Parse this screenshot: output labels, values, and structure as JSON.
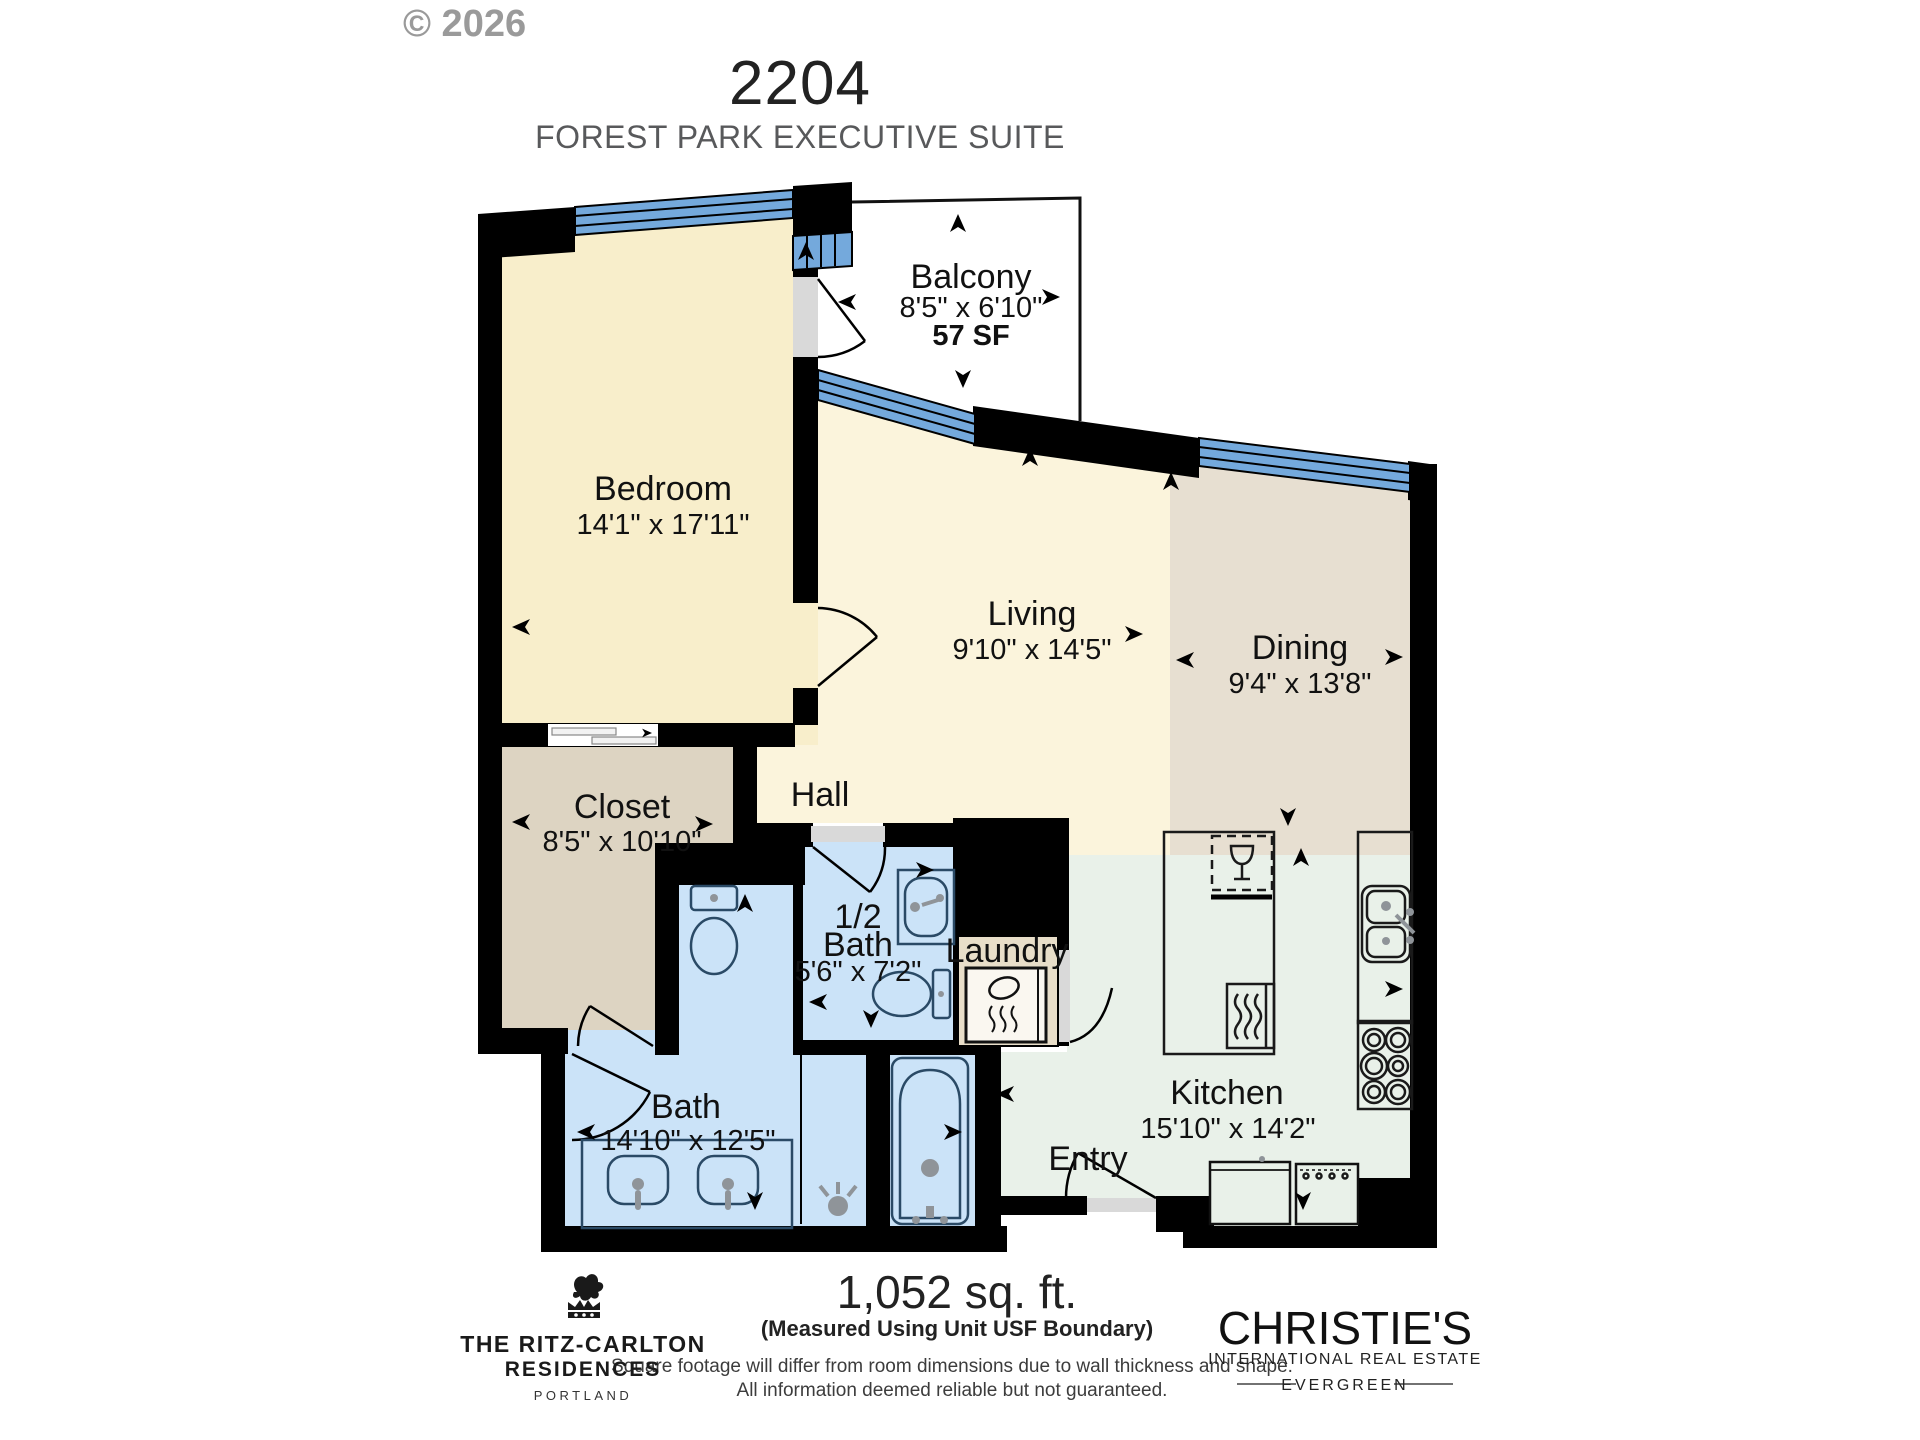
{
  "watermark": "© 2026",
  "header": {
    "unit_number": "2204",
    "suite_name": "FOREST PARK EXECUTIVE SUITE"
  },
  "rooms": {
    "balcony": {
      "name": "Balcony",
      "dims": "8'5\" x 6'10\"",
      "area": "57 SF"
    },
    "bedroom": {
      "name": "Bedroom",
      "dims": "14'1\" x 17'11\""
    },
    "living": {
      "name": "Living",
      "dims": "9'10\" x 14'5\""
    },
    "dining": {
      "name": "Dining",
      "dims": "9'4\" x 13'8\""
    },
    "closet": {
      "name": "Closet",
      "dims": "8'5\" x 10'10\""
    },
    "hall": {
      "name": "Hall"
    },
    "half_bath": {
      "name_line1": "1/2",
      "name_line2": "Bath",
      "dims": "5'6\" x 7'2\""
    },
    "laundry": {
      "name": "Laundry"
    },
    "bath": {
      "name": "Bath",
      "dims": "14'10\" x 12'5\""
    },
    "entry": {
      "name": "Entry"
    },
    "kitchen": {
      "name": "Kitchen",
      "dims": "15'10\" x 14'2\""
    }
  },
  "footer": {
    "total_area": "1,052 sq. ft.",
    "measure_note": "(Measured Using Unit USF Boundary)",
    "disclaimer_line1": "Square footage will differ from room dimensions due to wall thickness and shape.",
    "disclaimer_line2": "All information deemed reliable but not guaranteed.",
    "brand_left": {
      "line1": "THE RITZ-CARLTON",
      "line2": "RESIDENCES",
      "line3": "PORTLAND"
    },
    "brand_right": {
      "line1": "CHRISTIE'S",
      "line2": "INTERNATIONAL REAL ESTATE",
      "line3": "EVERGREEN"
    }
  },
  "colors": {
    "wall": "#000000",
    "window": "#74A9DC",
    "door": "#D9D9D9",
    "fixture": "#2A4A66",
    "bedroomFill": "#F8EECB",
    "livingFill": "#FBF4DC",
    "closetFill": "#DDD4C2",
    "diningFill": "#E7DFD1",
    "kitchenFill": "#E9F1E9",
    "bathFill": "#CBE3F8",
    "laundryFill": "#E8DEC9",
    "titleColor": "#222222",
    "subtitleColor": "#58595B",
    "watermarkColor": "#9A9A9A"
  }
}
